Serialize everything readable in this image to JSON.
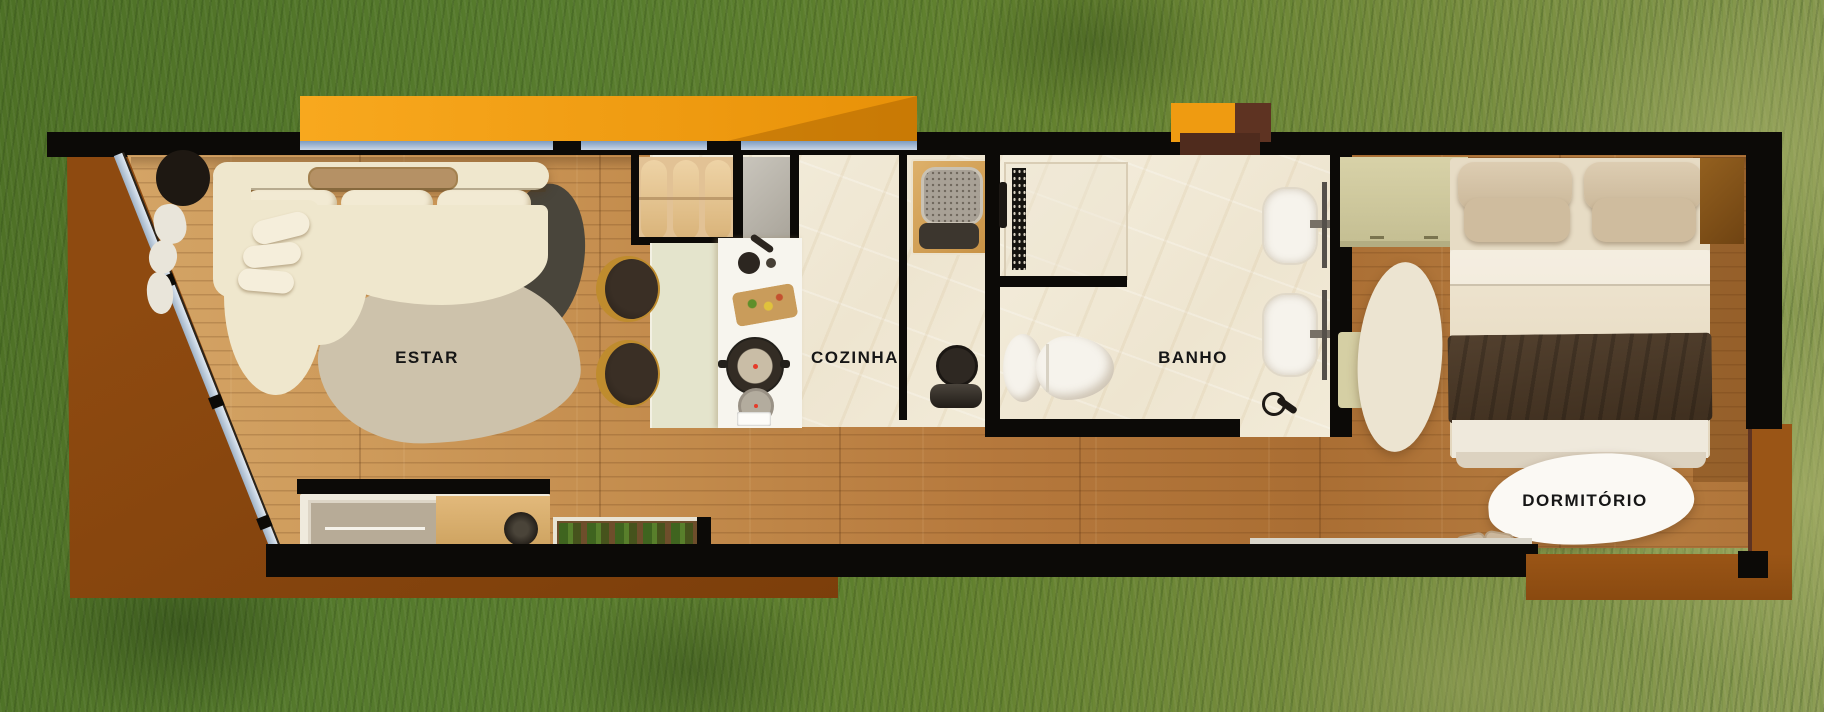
{
  "rooms": {
    "living": {
      "label": "ESTAR"
    },
    "kitchen": {
      "label": "COZINHA"
    },
    "bathroom": {
      "label": "BANHO"
    },
    "bedroom": {
      "label": "DORMITÓRIO"
    }
  },
  "colors": {
    "wall_black": "#0C0A07",
    "orange_deck": "#EF9B11",
    "rust_deck": "#8E4A10",
    "entry_mat": "#4F2B1D",
    "porch_brown": "#5E3322",
    "grass_green": "#5A7E2F",
    "grass_olive": "#8D9C55",
    "wood_light": "#D3A066",
    "wood_dark": "#AD6F36",
    "marble": "#F1EAD9",
    "sage": "#E4E4CC",
    "island_white": "#F7F5EE",
    "sofa_cream": "#EFE7CD",
    "rug_beige": "#CDC2AB",
    "rug_dark": "#49453B",
    "bench_wood": "#E2C295",
    "bed_linen": "#E7DCC5",
    "pillow": "#D8C8AE",
    "throw_brown": "#463524",
    "porcelain": "#F6F3EC",
    "desk_khaki": "#D5CFA4",
    "glass_blue": "#9FB2C6",
    "label_ink": "#161616"
  }
}
